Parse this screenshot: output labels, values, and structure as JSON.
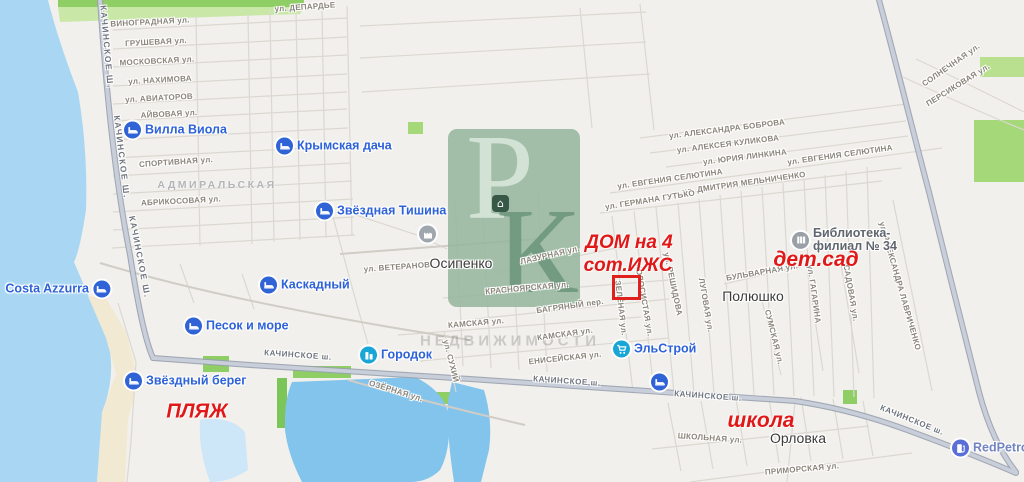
{
  "app": {
    "description": "map screenshot with real-estate annotations"
  },
  "colors": {
    "water": "#a9d7f3",
    "water_pale": "#cde7f8",
    "land": "#f2f0ec",
    "sand": "#f2e9d2",
    "green": "#a5d878",
    "green_bright": "#8fce65",
    "road_major_fill": "#c9cfda",
    "road_major_casing": "#99a1af",
    "road_minor": "#dbd8d1",
    "street_label": "#8a857a",
    "settlement_label": "#3c3c3c",
    "district_label": "#b2b5ba",
    "poi_blue": "#2f63d6",
    "poi_teal": "#18a6d6",
    "poi_gray": "#9aa0a6",
    "poi_violet": "#5a6ed8",
    "poi_label_blue": "#2d62d8",
    "poi_label_gray": "#5f666d",
    "poi_label_violet": "#7383bf",
    "annotation_red": "#e01818",
    "marker_red": "#e0201c",
    "watermark_green": "#96b69e"
  },
  "watermark": {
    "letters": [
      "Р",
      "К"
    ],
    "icon": "house-icon",
    "icon_glyph": "⌂",
    "caption": "НЕДВИЖИМОСТИ"
  },
  "marker": {
    "x": 612,
    "y": 275,
    "w": 23,
    "h": 19
  },
  "map": {
    "street_labels": [
      {
        "text": "ул. ДЕПАРДЬЕ",
        "x": 305,
        "y": 7,
        "rot": -4
      },
      {
        "text": "ВИНОГРАДНАЯ ул.",
        "x": 150,
        "y": 22,
        "rot": -3
      },
      {
        "text": "ГРУШЕВАЯ ул.",
        "x": 156,
        "y": 42,
        "rot": -3
      },
      {
        "text": "МОСКОВСКАЯ ул.",
        "x": 157,
        "y": 61,
        "rot": -3
      },
      {
        "text": "ул. НАХИМОВА",
        "x": 160,
        "y": 80,
        "rot": -3
      },
      {
        "text": "ул. АВИАТОРОВ",
        "x": 159,
        "y": 98,
        "rot": -3
      },
      {
        "text": "АЙВОВАЯ ул.",
        "x": 169,
        "y": 114,
        "rot": -3
      },
      {
        "text": "СПОРТИВНАЯ ул.",
        "x": 176,
        "y": 162,
        "rot": -4
      },
      {
        "text": "АБРИКОСОВАЯ ул.",
        "x": 181,
        "y": 201,
        "rot": -3
      },
      {
        "text": "КАЧИНСКОЕ Ш.",
        "x": 107,
        "y": 47,
        "rot": 85,
        "kind": "vroad"
      },
      {
        "text": "КАЧИНСКОЕ Ш.",
        "x": 122,
        "y": 157,
        "rot": 83,
        "kind": "vroad"
      },
      {
        "text": "КАЧИНСКОЕ Ш.",
        "x": 140,
        "y": 257,
        "rot": 79,
        "kind": "vroad"
      },
      {
        "text": "ул. АЛЕКСАНДРА БОБРОВА",
        "x": 727,
        "y": 129,
        "rot": -7
      },
      {
        "text": "ул. АЛЕКСЕЯ КУЛИКОВА",
        "x": 728,
        "y": 144,
        "rot": -7
      },
      {
        "text": "ул. ЮРИЯ ЛИНКИНА",
        "x": 745,
        "y": 157,
        "rot": -7
      },
      {
        "text": "ул. ЕВГЕНИЯ СЕЛЮТИНА",
        "x": 840,
        "y": 155,
        "rot": -8
      },
      {
        "text": "ул. ЕВГЕНИЯ СЕЛЮТИНА",
        "x": 670,
        "y": 179,
        "rot": -8
      },
      {
        "text": "ул. ДМИТРИЯ МЕЛЬНИЧЕНКО",
        "x": 744,
        "y": 183,
        "rot": -8
      },
      {
        "text": "ул. ГЕРМАНА ГУТЬКО",
        "x": 650,
        "y": 200,
        "rot": -9
      },
      {
        "text": "СОЛНЕЧНАЯ ул.",
        "x": 951,
        "y": 65,
        "rot": -35
      },
      {
        "text": "ПЕРСИКОВАЯ ул.",
        "x": 958,
        "y": 85,
        "rot": -32
      },
      {
        "text": "ул. АЛЕКСАНДРА ЛАВРИЧЕНКО",
        "x": 900,
        "y": 286,
        "rot": 74
      },
      {
        "text": "САДОВАЯ ул.",
        "x": 851,
        "y": 293,
        "rot": 80
      },
      {
        "text": "ул. ГАГАРИНА",
        "x": 814,
        "y": 294,
        "rot": 82
      },
      {
        "text": "СУМСКАЯ ул.",
        "x": 774,
        "y": 337,
        "rot": 76
      },
      {
        "text": "БУЛЬВАРНАЯ ул.",
        "x": 762,
        "y": 272,
        "rot": -10
      },
      {
        "text": "ЛУГОВАЯ ул.",
        "x": 706,
        "y": 305,
        "rot": 80
      },
      {
        "text": "ул. РЕШИДОВА",
        "x": 673,
        "y": 284,
        "rot": 78
      },
      {
        "text": "КОЛОСИСТАЯ ул.",
        "x": 644,
        "y": 300,
        "rot": 80
      },
      {
        "text": "ЗЕЛЁНАЯ ул.",
        "x": 621,
        "y": 308,
        "rot": 83
      },
      {
        "text": "ЛАЗУРНАЯ ул.",
        "x": 550,
        "y": 255,
        "rot": -13
      },
      {
        "text": "КРАСНОЯРСКАЯ ул.",
        "x": 527,
        "y": 288,
        "rot": -5
      },
      {
        "text": "БАГРЯНЫЙ пер.",
        "x": 570,
        "y": 306,
        "rot": -8
      },
      {
        "text": "КАМСКАЯ ул.",
        "x": 476,
        "y": 323,
        "rot": -5
      },
      {
        "text": "КАМСКАЯ ул.",
        "x": 565,
        "y": 334,
        "rot": -8
      },
      {
        "text": "ЕНИСЕЙСКАЯ ул.",
        "x": 565,
        "y": 358,
        "rot": -6
      },
      {
        "text": "ул. ВЕТЕРАНОВ",
        "x": 397,
        "y": 267,
        "rot": -4
      },
      {
        "text": "ул. СУХИЙ",
        "x": 451,
        "y": 361,
        "rot": 76
      },
      {
        "text": "ОЗЁРНАЯ ул.",
        "x": 396,
        "y": 391,
        "rot": 17
      },
      {
        "text": "КАЧИНСКОЕ ш.",
        "x": 298,
        "y": 355,
        "rot": 4,
        "kind": "road"
      },
      {
        "text": "КАЧИНСКОЕ ш.",
        "x": 567,
        "y": 381,
        "rot": 4,
        "kind": "road"
      },
      {
        "text": "КАЧИНСКОЕ ш.",
        "x": 708,
        "y": 396,
        "rot": 4,
        "kind": "road"
      },
      {
        "text": "КАЧИНСКОЕ ш.",
        "x": 912,
        "y": 420,
        "rot": 22,
        "kind": "road"
      },
      {
        "text": "ШКОЛЬНАЯ ул.",
        "x": 710,
        "y": 438,
        "rot": 4
      },
      {
        "text": "ПРИМОРСКАЯ ул.",
        "x": 802,
        "y": 469,
        "rot": -5
      }
    ],
    "settlements": [
      {
        "text": "Осипенко",
        "x": 461,
        "y": 263
      },
      {
        "text": "Полюшко",
        "x": 753,
        "y": 296
      },
      {
        "text": "Орловка",
        "x": 798,
        "y": 438
      }
    ],
    "districts": [
      {
        "text": "АДМИРАЛЬСКАЯ",
        "x": 217,
        "y": 185
      }
    ],
    "pois": [
      {
        "id": "villa-viola",
        "label": "Вилла Виола",
        "x": 133,
        "y": 130,
        "icon": "bed",
        "icon_color": "#2f63d6",
        "label_color": "#2d62d8",
        "side": "right"
      },
      {
        "id": "krymskaya-dacha",
        "label": "Крымская дача",
        "x": 285,
        "y": 146,
        "icon": "bed",
        "icon_color": "#2f63d6",
        "label_color": "#2d62d8",
        "side": "right"
      },
      {
        "id": "zvezdnaya-tishina",
        "label": "Звёздная Тишина",
        "x": 325,
        "y": 211,
        "icon": "bed",
        "icon_color": "#2f63d6",
        "label_color": "#2d62d8",
        "side": "right"
      },
      {
        "id": "kaskadny",
        "label": "Каскадный",
        "x": 269,
        "y": 285,
        "icon": "bed",
        "icon_color": "#2f63d6",
        "label_color": "#2d62d8",
        "side": "right"
      },
      {
        "id": "costa-azzurra",
        "label": "Costa Azzurra",
        "x": 101,
        "y": 289,
        "icon": "bed",
        "icon_color": "#2f63d6",
        "label_color": "#2d62d8",
        "side": "left"
      },
      {
        "id": "pesok-i-more",
        "label": "Песок и море",
        "x": 194,
        "y": 326,
        "icon": "bed",
        "icon_color": "#2f63d6",
        "label_color": "#2d62d8",
        "side": "right"
      },
      {
        "id": "zvezdny-bereg",
        "label": "Звёздный берег",
        "x": 134,
        "y": 381,
        "icon": "bed",
        "icon_color": "#2f63d6",
        "label_color": "#2d62d8",
        "side": "right"
      },
      {
        "id": "gorodok",
        "label": "Городок",
        "x": 369,
        "y": 355,
        "icon": "building",
        "icon_color": "#18a6d6",
        "label_color": "#2d62d8",
        "side": "right"
      },
      {
        "id": "elstroy",
        "label": "ЭльСтрой",
        "x": 622,
        "y": 349,
        "icon": "cart",
        "icon_color": "#18a6d6",
        "label_color": "#2d62d8",
        "side": "right"
      },
      {
        "id": "hotel-unlabeled",
        "label": "",
        "x": 660,
        "y": 382,
        "icon": "bed",
        "icon_color": "#2f63d6",
        "label_color": "#2d62d8",
        "side": "right"
      },
      {
        "id": "biblioteka-filial-34",
        "label_lines": [
          "Библиотека-",
          "филиал № 34"
        ],
        "x": 801,
        "y": 240,
        "icon": "library",
        "icon_color": "#9aa0a6",
        "label_color": "#5f666d",
        "side": "right"
      },
      {
        "id": "redpetrol",
        "label": "RedPetrol",
        "x": 961,
        "y": 448,
        "icon": "fuel",
        "icon_color": "#5a6ed8",
        "label_color": "#7383bf",
        "side": "right"
      },
      {
        "id": "factory",
        "label": "",
        "x": 428,
        "y": 234,
        "icon": "factory",
        "icon_color": "#a0a6ad",
        "side": "right"
      }
    ],
    "annotations": [
      {
        "text": "ДОМ на 4",
        "x": 629,
        "y": 243,
        "size": 19
      },
      {
        "text": "сот.ИЖС",
        "x": 628,
        "y": 266,
        "size": 19
      },
      {
        "text": "дет.сад",
        "x": 816,
        "y": 260,
        "size": 21
      },
      {
        "text": "ПЛЯЖ",
        "x": 197,
        "y": 412,
        "size": 20
      },
      {
        "text": "школа",
        "x": 761,
        "y": 421,
        "size": 21
      }
    ]
  }
}
